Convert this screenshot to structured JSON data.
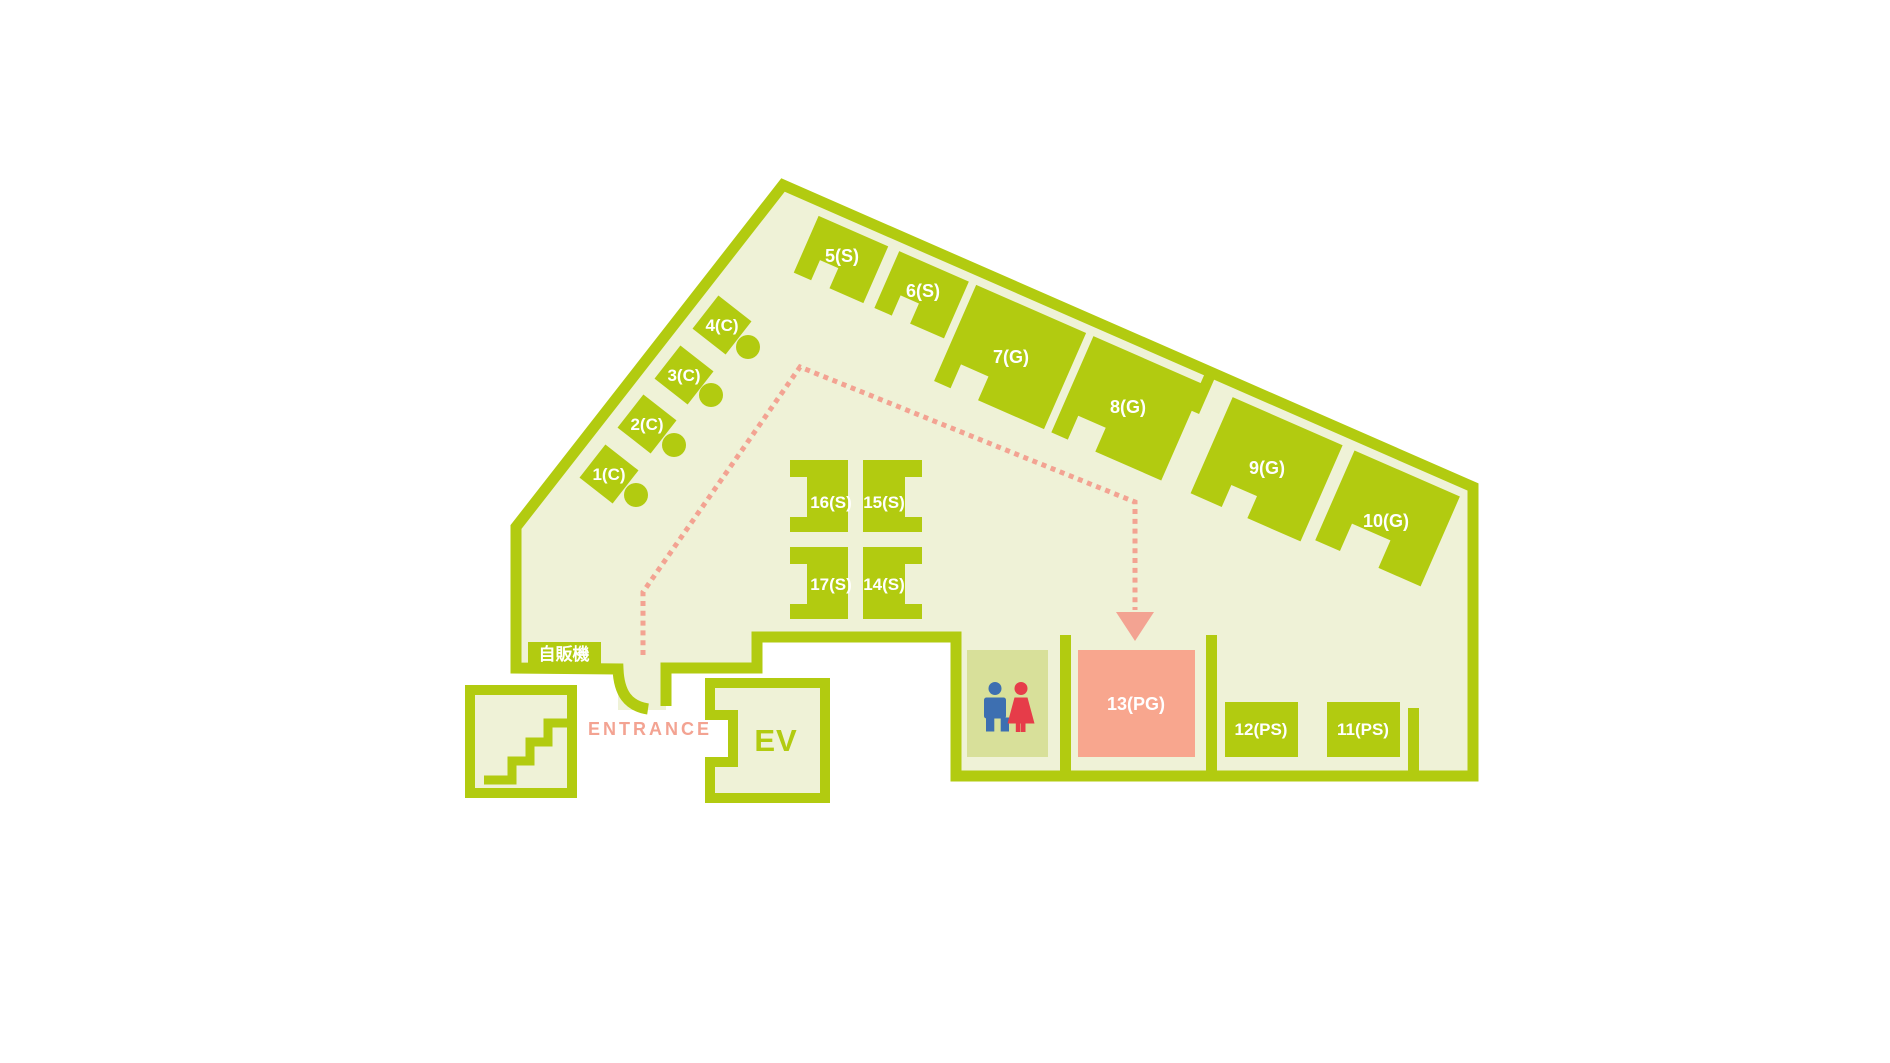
{
  "rooms": {
    "r1": {
      "label": "1(C)"
    },
    "r2": {
      "label": "2(C)"
    },
    "r3": {
      "label": "3(C)"
    },
    "r4": {
      "label": "4(C)"
    },
    "r5": {
      "label": "5(S)"
    },
    "r6": {
      "label": "6(S)"
    },
    "r7": {
      "label": "7(G)"
    },
    "r8": {
      "label": "8(G)"
    },
    "r9": {
      "label": "9(G)"
    },
    "r10": {
      "label": "10(G)"
    },
    "r11": {
      "label": "11(PS)"
    },
    "r12": {
      "label": "12(PS)"
    },
    "r13": {
      "label": "13(PG)"
    },
    "r14": {
      "label": "14(S)"
    },
    "r15": {
      "label": "15(S)"
    },
    "r16": {
      "label": "16(S)"
    },
    "r17": {
      "label": "17(S)"
    }
  },
  "facilities": {
    "vending": {
      "label": "自販機"
    },
    "elevator": {
      "label": "EV"
    },
    "entrance": {
      "label": "ENTRANCE"
    },
    "stairs": {
      "icon": "stairs-icon"
    },
    "restroom": {
      "male_icon": "male-icon",
      "female_icon": "female-icon"
    }
  },
  "route": {
    "arrow": "route-arrow-icon"
  },
  "colors": {
    "wall": "#B2CB10",
    "floor": "#EFF2D7",
    "toilet": "#D8E09A",
    "pink": "#F8A68E",
    "route": "#F3A392",
    "male": "#3D6FB1",
    "female": "#E63C49",
    "label": "#FFFFFF"
  }
}
